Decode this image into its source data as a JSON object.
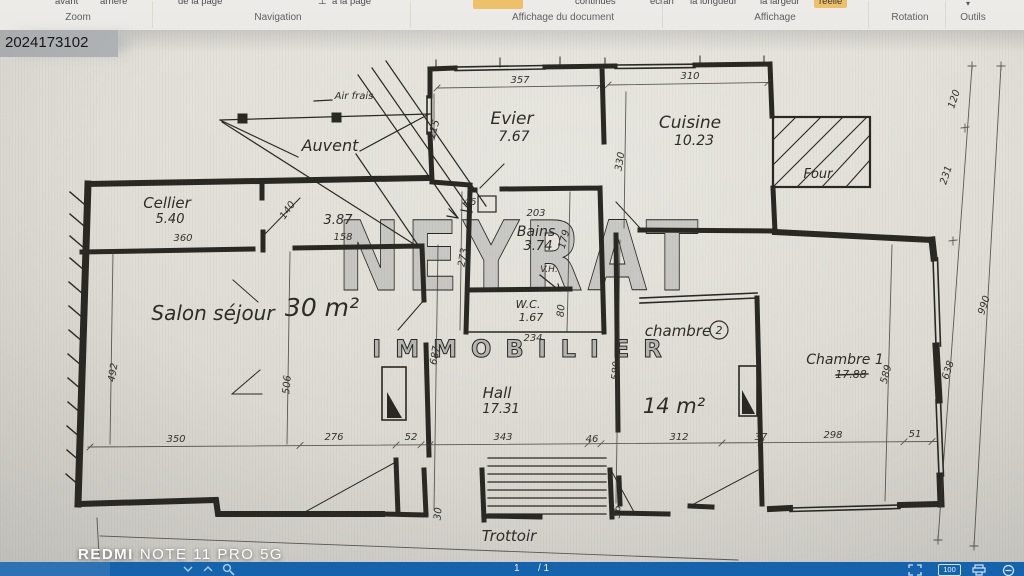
{
  "ribbon": {
    "caret": "▾",
    "fit_icon": "⊥",
    "top_partials": [
      {
        "t": "avant",
        "x": 55
      },
      {
        "t": "arrière",
        "x": 100
      },
      {
        "t": "de la page",
        "x": 178
      },
      {
        "t": "à la page",
        "x": 332
      },
      {
        "t": "continues",
        "x": 575
      },
      {
        "t": "écran",
        "x": 650
      },
      {
        "t": "la longueur",
        "x": 690
      },
      {
        "t": "la largeur",
        "x": 760
      },
      {
        "t": "réelle",
        "x": 814,
        "hl": true
      }
    ],
    "groups": [
      {
        "t": "Zoom",
        "x": 78
      },
      {
        "t": "Navigation",
        "x": 278
      },
      {
        "t": "Affichage du document",
        "x": 563
      },
      {
        "t": "Affichage",
        "x": 775
      },
      {
        "t": "Rotation",
        "x": 910
      },
      {
        "t": "Outils",
        "x": 973
      }
    ]
  },
  "photo": {
    "ref": "2024173102",
    "device": {
      "bold": "REDMI",
      "rest": "NOTE 11 PRO 5G"
    }
  },
  "statusbar": {
    "page": "1",
    "of": "/ 1",
    "zoom": "100"
  },
  "plan": {
    "watermark": {
      "big": "NEYRAT",
      "small": "IMMOBILIER"
    },
    "labels": [
      {
        "t": "Evier",
        "x": 512,
        "y": 124,
        "s": 17
      },
      {
        "t": "7.67",
        "x": 514,
        "y": 141,
        "s": 14
      },
      {
        "t": "Cuisine",
        "x": 690,
        "y": 128,
        "s": 17
      },
      {
        "t": "10.23",
        "x": 694,
        "y": 145,
        "s": 14
      },
      {
        "t": "Four",
        "x": 818,
        "y": 178,
        "s": 13
      },
      {
        "t": "Auvent",
        "x": 330,
        "y": 151,
        "s": 16
      },
      {
        "t": "Air frais",
        "x": 354,
        "y": 99,
        "s": 10
      },
      {
        "t": "Cellier",
        "x": 167,
        "y": 208,
        "s": 15
      },
      {
        "t": "5.40",
        "x": 170,
        "y": 223,
        "s": 13
      },
      {
        "t": "3.87",
        "x": 338,
        "y": 224,
        "s": 13
      },
      {
        "t": "Bains",
        "x": 536,
        "y": 236,
        "s": 14
      },
      {
        "t": "3.74",
        "x": 538,
        "y": 250,
        "s": 13
      },
      {
        "t": "V.H.",
        "x": 549,
        "y": 272,
        "s": 9
      },
      {
        "t": "W.C.",
        "x": 528,
        "y": 308,
        "s": 11
      },
      {
        "t": "1.67",
        "x": 531,
        "y": 321,
        "s": 11
      },
      {
        "t": "Salon séjour",
        "x": 213,
        "y": 320,
        "s": 20
      },
      {
        "t": "30 m²",
        "x": 322,
        "y": 316,
        "s": 25
      },
      {
        "t": "Hall",
        "x": 497,
        "y": 398,
        "s": 15
      },
      {
        "t": "17.31",
        "x": 501,
        "y": 413,
        "s": 13
      },
      {
        "t": "chambre",
        "x": 678,
        "y": 336,
        "s": 15
      },
      {
        "t": "2",
        "x": 719,
        "y": 334,
        "s": 11,
        "circ": true
      },
      {
        "t": "14 m²",
        "x": 674,
        "y": 413,
        "s": 21
      },
      {
        "t": "Chambre 1",
        "x": 845,
        "y": 364,
        "s": 14
      },
      {
        "t": "17.88",
        "x": 851,
        "y": 378,
        "s": 11,
        "strike": true
      },
      {
        "t": "Trottoir",
        "x": 509,
        "y": 541,
        "s": 15
      }
    ],
    "dims": [
      {
        "t": "357",
        "x": 520,
        "y": 83
      },
      {
        "t": "310",
        "x": 690,
        "y": 79
      },
      {
        "t": "215",
        "x": 437,
        "y": 130,
        "r": -75
      },
      {
        "t": "330",
        "x": 623,
        "y": 162,
        "r": -80
      },
      {
        "t": "360",
        "x": 183,
        "y": 241
      },
      {
        "t": "158",
        "x": 343,
        "y": 240
      },
      {
        "t": "140",
        "x": 290,
        "y": 212,
        "r": -55
      },
      {
        "t": "203",
        "x": 536,
        "y": 216
      },
      {
        "t": "46",
        "x": 470,
        "y": 205
      },
      {
        "t": "179",
        "x": 567,
        "y": 240,
        "r": -75
      },
      {
        "t": "273",
        "x": 466,
        "y": 258,
        "r": -80
      },
      {
        "t": "80",
        "x": 564,
        "y": 311,
        "r": -85
      },
      {
        "t": "234",
        "x": 533,
        "y": 341
      },
      {
        "t": "687",
        "x": 438,
        "y": 356,
        "r": -80
      },
      {
        "t": "580",
        "x": 619,
        "y": 371,
        "r": -85
      },
      {
        "t": "492",
        "x": 116,
        "y": 373,
        "r": -80
      },
      {
        "t": "506",
        "x": 290,
        "y": 385,
        "r": -85
      },
      {
        "t": "350",
        "x": 176,
        "y": 442
      },
      {
        "t": "276",
        "x": 334,
        "y": 440
      },
      {
        "t": "52",
        "x": 411,
        "y": 440
      },
      {
        "t": "343",
        "x": 503,
        "y": 440
      },
      {
        "t": "46",
        "x": 592,
        "y": 442
      },
      {
        "t": "312",
        "x": 679,
        "y": 440
      },
      {
        "t": "37",
        "x": 761,
        "y": 440
      },
      {
        "t": "298",
        "x": 833,
        "y": 438
      },
      {
        "t": "51",
        "x": 915,
        "y": 437
      },
      {
        "t": "589",
        "x": 889,
        "y": 375,
        "r": -75
      },
      {
        "t": "120",
        "x": 957,
        "y": 100,
        "r": -72
      },
      {
        "t": "231",
        "x": 949,
        "y": 176,
        "r": -72
      },
      {
        "t": "990",
        "x": 987,
        "y": 306,
        "r": -72
      },
      {
        "t": "638",
        "x": 951,
        "y": 371,
        "r": -72
      },
      {
        "t": "30",
        "x": 441,
        "y": 514,
        "r": -85
      },
      {
        "t": "36",
        "x": 620,
        "y": 512,
        "r": -85
      }
    ]
  }
}
